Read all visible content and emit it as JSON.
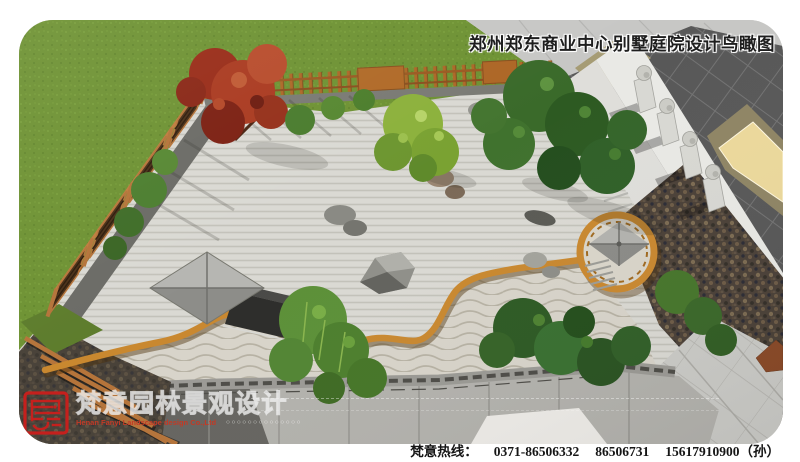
{
  "header": {
    "title": "郑州郑东商业中心别墅庭院设计鸟瞰图"
  },
  "brand": {
    "seal_text": "梵意",
    "company_cn": "梵意园林景观设计",
    "company_en": "Henan Fanyi Landscape design Co.,Ltd",
    "deco_dots": "○○○○○○○○○○○○○○"
  },
  "footer": {
    "hotline_label": "梵意热线：",
    "phones": [
      "0371-86506332",
      "86506731",
      "15617910900（孙）"
    ]
  },
  "palette": {
    "lawn_green": "#6e9233",
    "gravel": "#d9d8d2",
    "timber_edge": "#c9882f",
    "fence_wood": "#ad6827",
    "maple_red": "#aa3a20",
    "pine_green": "#2d5a22",
    "dark_tile_wall": "#585858",
    "pebble_granite": "#4b4138",
    "window_glow": "#ecd99c",
    "seal_red": "#c5201d"
  }
}
